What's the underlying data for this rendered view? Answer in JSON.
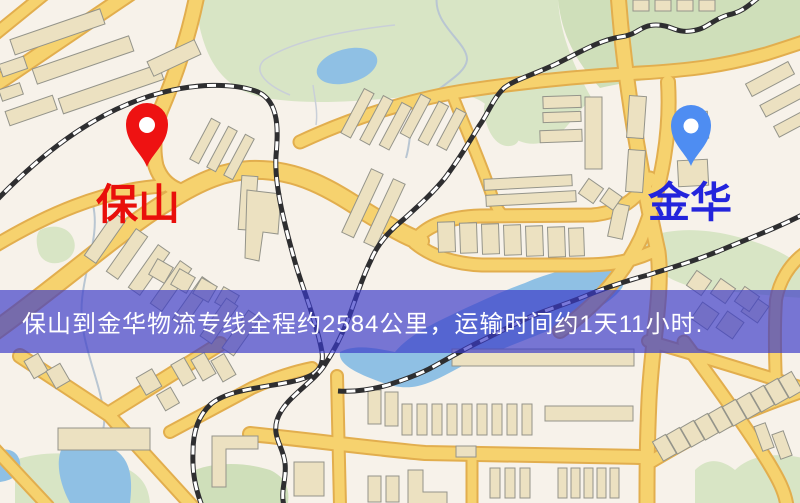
{
  "banner": {
    "text": "保山到金华物流专线全程约2584公里，运输时间约1天11小时.",
    "background_color": "rgba(58,58,200,0.68)",
    "text_color": "#ffffff"
  },
  "markers": [
    {
      "id": "origin",
      "label": "保山",
      "pin_color": "#ee1212",
      "label_color": "#e90f0b"
    },
    {
      "id": "destination",
      "label": "金华",
      "pin_color": "#4e8df2",
      "label_color": "#2324dc"
    }
  ],
  "map_palette": {
    "background": "#f7f2ea",
    "road_fill": "#f6d26e",
    "road_casing": "#e2ae4e",
    "building": "#ece1c1",
    "park": "#d8e5c5",
    "water": "#8fc0e4",
    "railway": "#2e2e30"
  }
}
